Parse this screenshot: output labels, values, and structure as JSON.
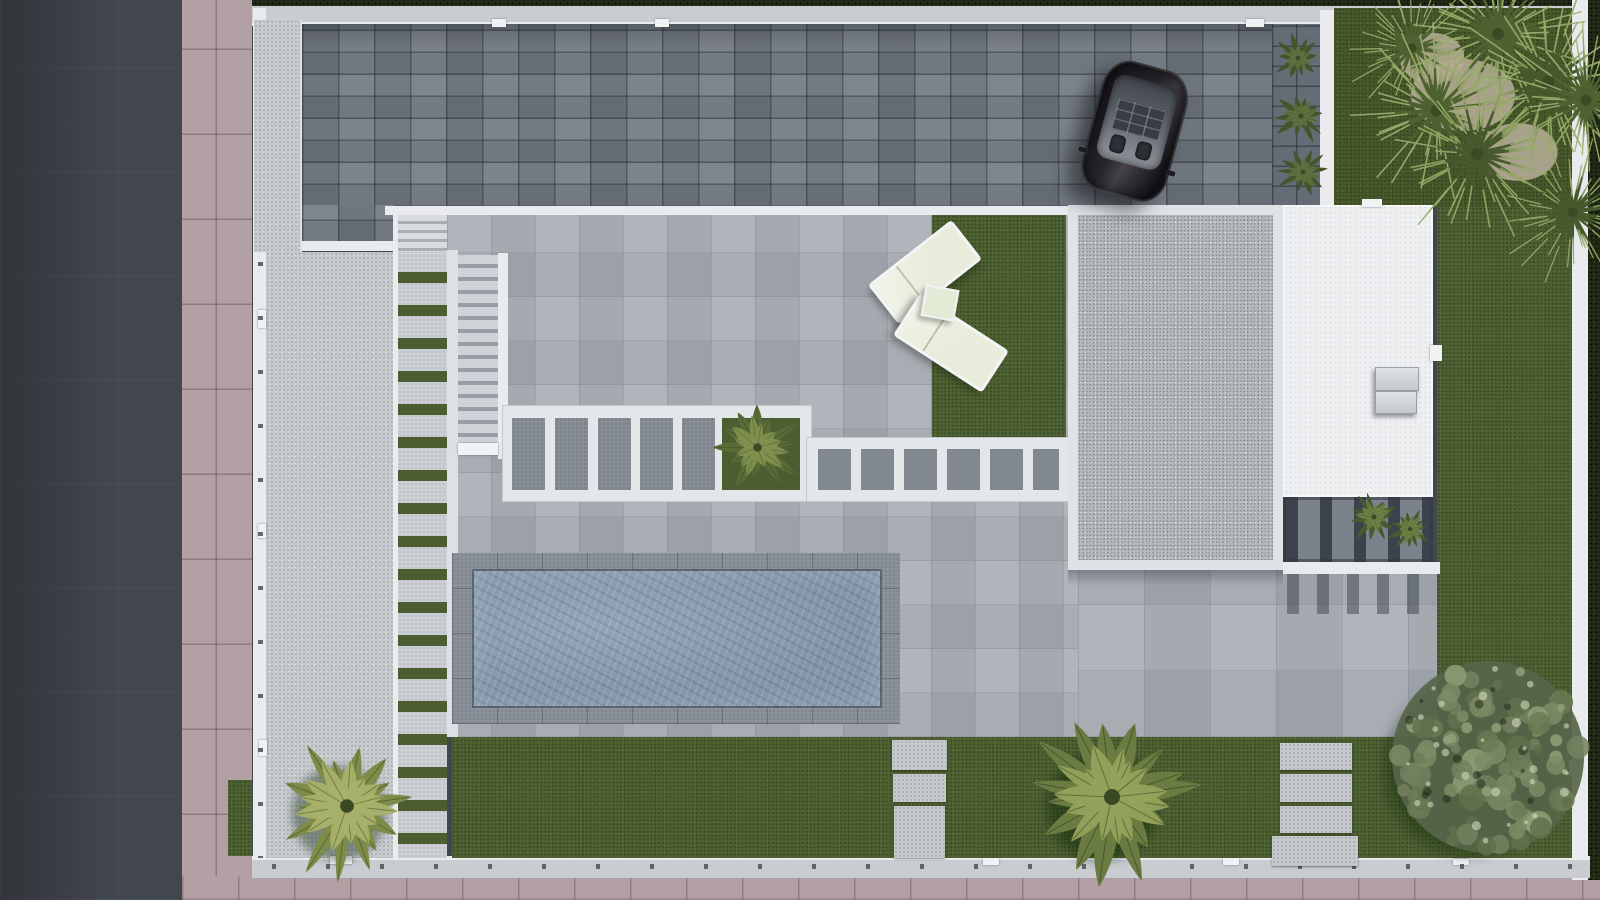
{
  "scene": {
    "type": "top-down-aerial-render-of-modern-villa-plot",
    "objects": {
      "road": 1,
      "sidewalk": 1,
      "perimeter_wall": 1,
      "boundary_hedge": 1,
      "paver_driveway": 1,
      "parked_car": 1,
      "flat_roofs": 2,
      "rooftop_ac_units": 2,
      "pergolas": 3,
      "swimming_pool": 1,
      "sun_loungers": 2,
      "side_table": 1,
      "external_staircases": 2,
      "stepping_stone_paths": 3,
      "lawns": 3,
      "palm_trees": 15,
      "shade_tree": 1,
      "planter_beds": 2
    }
  },
  "palette": {
    "road": "#42464d",
    "sidewalk": "#b3a0a5",
    "wall_light": "#c9cdd1",
    "wall_bright": "#e9ebee",
    "hedge": "#1c2413",
    "driveway": "#747b84",
    "concrete": "#c6cacd",
    "patio": "#a9aeb5",
    "walkway": "#ccd0d4",
    "grass_strip": "#4c5e31",
    "lawn": "#4e6132",
    "lawn_dark": "#47592b",
    "pool_water": "#8495a9",
    "pool_rim": "#8b9199",
    "roof_gravel": "#b4b8bd",
    "roof_white": "#edeff1",
    "pergola_white": "#e4e7ea",
    "lounger": "#e9ecdb",
    "car_body": "#26232a",
    "palm_light": "#a8b169",
    "palm_mid": "#8b9a55",
    "palm_dark": "#546a30",
    "tree_gray_green": "#73815f",
    "sand": "#b4aa95"
  },
  "vegetation": [
    {
      "kind": "patch",
      "x": 1463,
      "y": 95,
      "w": 58,
      "h": 40
    },
    {
      "kind": "patch",
      "x": 1432,
      "y": 58,
      "w": 36,
      "h": 28
    },
    {
      "kind": "patch",
      "x": 1518,
      "y": 152,
      "w": 44,
      "h": 32
    },
    {
      "kind": "palm",
      "type": "feather",
      "x": 347,
      "y": 806,
      "size": 170,
      "c1": "#a8b169",
      "c2": "#7e8c4a",
      "fronds": 14,
      "seed": 7,
      "shadow": true
    },
    {
      "kind": "palm",
      "type": "feather",
      "x": 1112,
      "y": 797,
      "size": 200,
      "c1": "#93a35c",
      "c2": "#6a7c41",
      "fronds": 15,
      "seed": 11,
      "shadow": true
    },
    {
      "kind": "palm",
      "type": "feather",
      "x": 757,
      "y": 447,
      "size": 105,
      "c1": "#7f904f",
      "c2": "#596b36",
      "fronds": 12,
      "seed": 5,
      "shadow": false
    },
    {
      "kind": "palm",
      "type": "feather",
      "x": 1298,
      "y": 58,
      "size": 58,
      "c1": "#5f7240",
      "c2": "#46572c",
      "fronds": 10,
      "seed": 3,
      "shadow": false
    },
    {
      "kind": "palm",
      "type": "feather",
      "x": 1301,
      "y": 116,
      "size": 64,
      "c1": "#5f7240",
      "c2": "#46572c",
      "fronds": 10,
      "seed": 4,
      "shadow": false
    },
    {
      "kind": "palm",
      "type": "feather",
      "x": 1303,
      "y": 172,
      "size": 60,
      "c1": "#5f7240",
      "c2": "#46572c",
      "fronds": 10,
      "seed": 9,
      "shadow": false
    },
    {
      "kind": "palm",
      "type": "feather",
      "x": 1374,
      "y": 517,
      "size": 62,
      "c1": "#6d8046",
      "c2": "#4b5c30",
      "fronds": 11,
      "seed": 13,
      "shadow": false
    },
    {
      "kind": "palm",
      "type": "feather",
      "x": 1410,
      "y": 529,
      "size": 54,
      "c1": "#6d8046",
      "c2": "#4b5c30",
      "fronds": 11,
      "seed": 14,
      "shadow": false
    },
    {
      "kind": "tree",
      "x": 1488,
      "y": 757,
      "size": 240,
      "seed": 31
    },
    {
      "kind": "palm",
      "type": "spiky",
      "x": 1412,
      "y": 48,
      "size": 150,
      "c1": "#4e6130",
      "c2": "#a3b573",
      "fronds": 20,
      "seed": 25,
      "shadow": false
    },
    {
      "kind": "palm",
      "type": "spiky",
      "x": 1498,
      "y": 34,
      "size": 200,
      "c1": "#4e6130",
      "c2": "#a3b573",
      "fronds": 22,
      "seed": 21,
      "shadow": false
    },
    {
      "kind": "palm",
      "type": "spiky",
      "x": 1548,
      "y": 82,
      "size": 210,
      "c1": "#46592c",
      "c2": "#9cb06d",
      "fronds": 22,
      "seed": 22,
      "shadow": false
    },
    {
      "kind": "palm",
      "type": "spiky",
      "x": 1436,
      "y": 110,
      "size": 195,
      "c1": "#4e6130",
      "c2": "#a3b573",
      "fronds": 21,
      "seed": 23,
      "shadow": false
    },
    {
      "kind": "palm",
      "type": "spiky",
      "x": 1477,
      "y": 154,
      "size": 200,
      "c1": "#46592c",
      "c2": "#9cb06d",
      "fronds": 21,
      "seed": 24,
      "shadow": false
    },
    {
      "kind": "palm",
      "type": "spiky",
      "x": 1586,
      "y": 100,
      "size": 180,
      "c1": "#4e6130",
      "c2": "#a3b573",
      "fronds": 20,
      "seed": 26,
      "shadow": false
    },
    {
      "kind": "palm",
      "type": "spiky",
      "x": 1572,
      "y": 212,
      "size": 165,
      "c1": "#46592c",
      "c2": "#9cb06d",
      "fronds": 20,
      "seed": 27,
      "shadow": false
    }
  ]
}
